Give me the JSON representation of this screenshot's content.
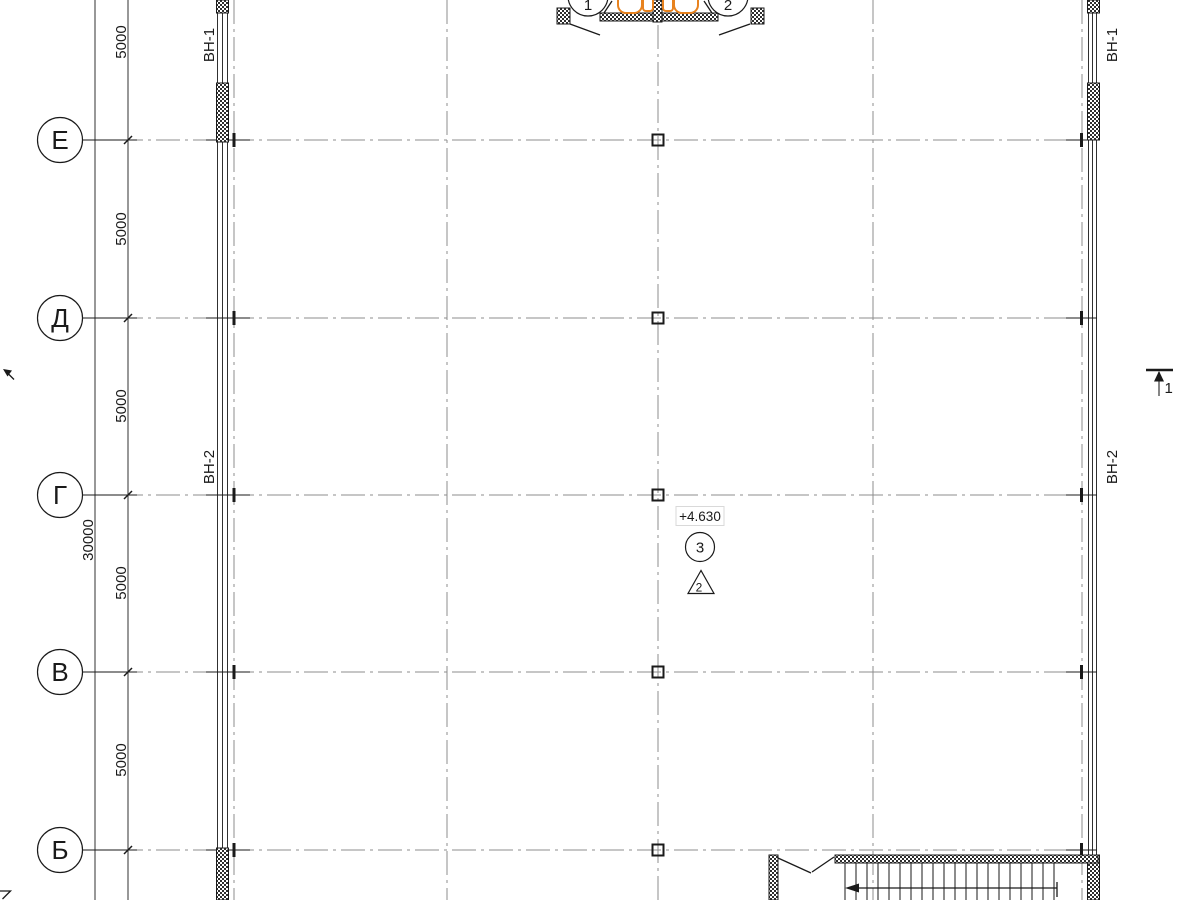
{
  "drawing": {
    "row_axes": [
      {
        "label": "Е"
      },
      {
        "label": "Д"
      },
      {
        "label": "Г"
      },
      {
        "label": "В"
      },
      {
        "label": "Б"
      }
    ],
    "top_axes": [
      {
        "label": "1"
      },
      {
        "label": "2"
      }
    ],
    "dims": {
      "bays": [
        "5000",
        "5000",
        "5000",
        "5000",
        "5000"
      ],
      "total": "30000"
    },
    "wall_tags": {
      "left_top": "ВН-1",
      "left_mid": "ВН-2",
      "right_top": "ВН-1",
      "right_mid": "ВН-2"
    },
    "annotations": {
      "level_mark": "+4.630",
      "node_circle": "3",
      "node_triangle": "2",
      "section_label_right": "1"
    },
    "colors": {
      "line": "#1a1a1a",
      "grid": "#8c8c8c",
      "fixture": "#e8821e"
    }
  }
}
